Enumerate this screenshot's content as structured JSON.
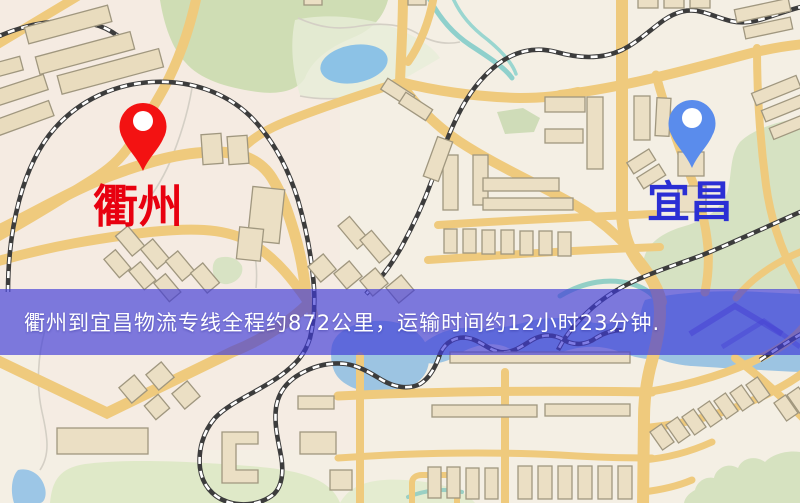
{
  "map": {
    "origin": {
      "label": "衢州",
      "label_color": "#e8000f",
      "pin_color": "#f31212",
      "pin_icon": "red-location-pin"
    },
    "destination": {
      "label": "宜昌",
      "label_color": "#2b2fd4",
      "pin_color": "#5a8cec",
      "pin_icon": "blue-location-pin"
    },
    "features": {
      "road_color": "#efca7d",
      "park_color": "#cfddb4",
      "water_color": "#9cc4e2",
      "building_fill": "#ebdfc4",
      "railway_color": "#3c3c3c"
    }
  },
  "banner": {
    "text": "衢州到宜昌物流专线全程约872公里，运输时间约12小时23分钟.",
    "background_color": "#4a46d8",
    "text_color": "#ffffff",
    "route": {
      "origin": "衢州",
      "destination": "宜昌",
      "distance_km": "872",
      "duration_hours": "12",
      "duration_minutes": "23"
    }
  }
}
